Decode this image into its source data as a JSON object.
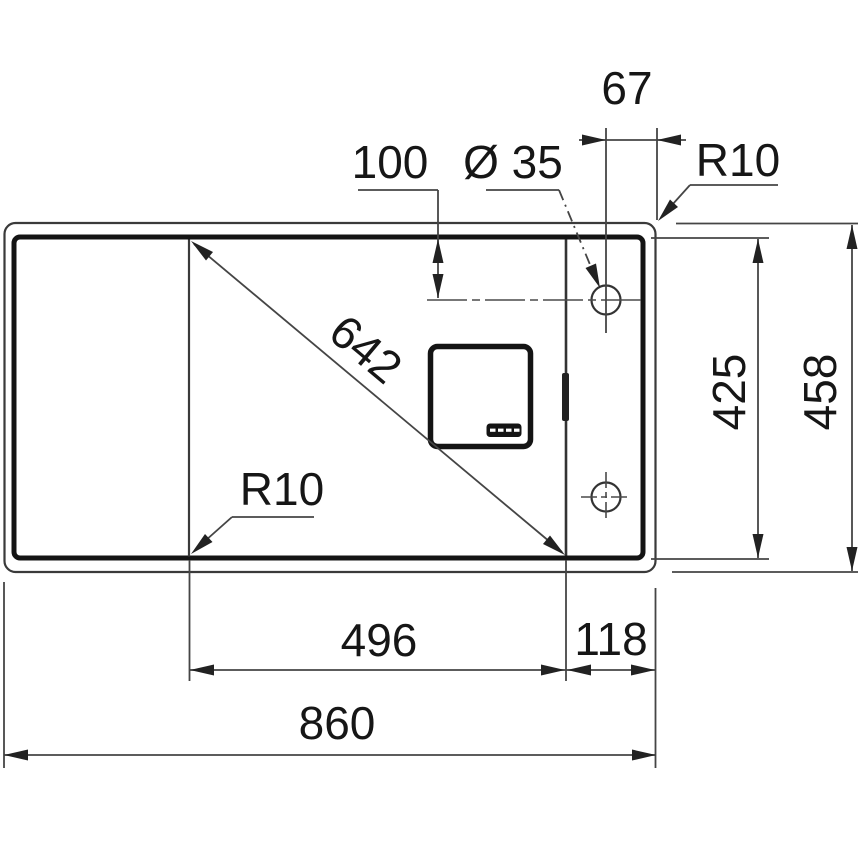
{
  "drawing": {
    "kind": "sink-dimension-drawing",
    "background": "#ffffff",
    "line_color": "#333333",
    "thick_line_color": "#141414",
    "text_color": "#161616",
    "labels": {
      "overall_width": "860",
      "overall_depth": "458",
      "bowl_width": "496",
      "bowl_depth": "425",
      "bowl_diagonal": "642",
      "tap_ledge_width": "118",
      "tap_hole_diameter": "Ø 35",
      "tap_hole_offset_from_edge": "67",
      "tap_hole_offset_from_top": "100",
      "outer_corner_radius": "R10",
      "bowl_corner_radius": "R10"
    }
  }
}
